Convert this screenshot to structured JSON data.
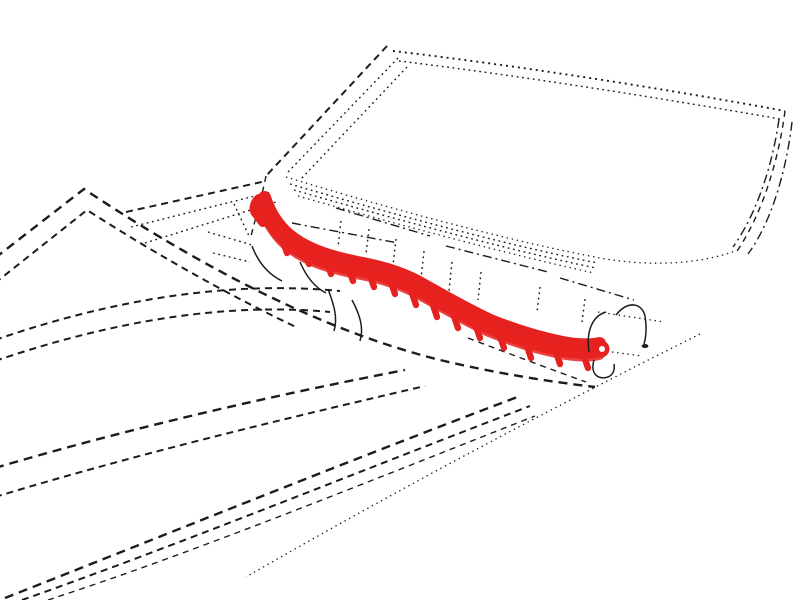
{
  "figure": {
    "kind": "patent-style technical line drawing",
    "subject": "vehicle windshield / cowl area, dashed environment lines with one part highlighted in red",
    "parts": [
      "windshield-outline",
      "a-pillar",
      "hood-edge-lines",
      "body-side-dashed-lines",
      "cowl-detail-lines",
      "highlighted-cowl-trim-strip",
      "trim-mounting-tabs",
      "trim-end-cap",
      "hose-hook-lines",
      "belt-line-dotted"
    ]
  },
  "colors": {
    "highlight": "#e62220",
    "ink": "#1c1c1c",
    "paper": "#ffffff"
  }
}
